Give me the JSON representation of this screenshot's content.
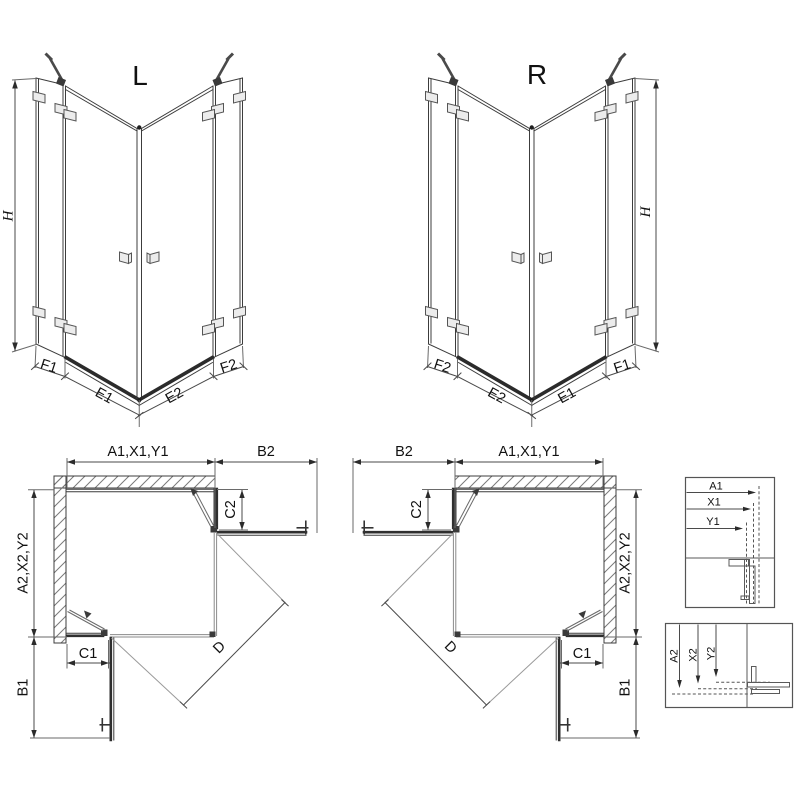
{
  "colors": {
    "line": "#3c3c3c",
    "dark": "#1f1f1f",
    "hatch": "#7a7a7a",
    "text": "#111111",
    "background": "#ffffff"
  },
  "iso_left": {
    "variant": "L",
    "height": "H",
    "segments": [
      "F1",
      "E1",
      "E2",
      "F2"
    ]
  },
  "iso_right": {
    "variant": "R",
    "height": "H",
    "segments": [
      "F2",
      "E2",
      "E1",
      "F1"
    ]
  },
  "plan_left": {
    "width_top": "A1,X1,Y1",
    "door_width": "B2",
    "depth_side": "A2,X2,Y2",
    "door_depth": "B1",
    "fixed_bottom": "C1",
    "fixed_side": "C2",
    "diagonal": "D"
  },
  "plan_right": {
    "width_top": "A1,X1,Y1",
    "door_width": "B2",
    "depth_side": "A2,X2,Y2",
    "door_depth": "B1",
    "fixed_bottom": "C1",
    "fixed_side": "C2",
    "diagonal": "D"
  },
  "detail_width": {
    "rows": [
      "A1",
      "X1",
      "Y1"
    ]
  },
  "detail_depth": {
    "rows": [
      "A2",
      "X2",
      "Y2"
    ]
  }
}
